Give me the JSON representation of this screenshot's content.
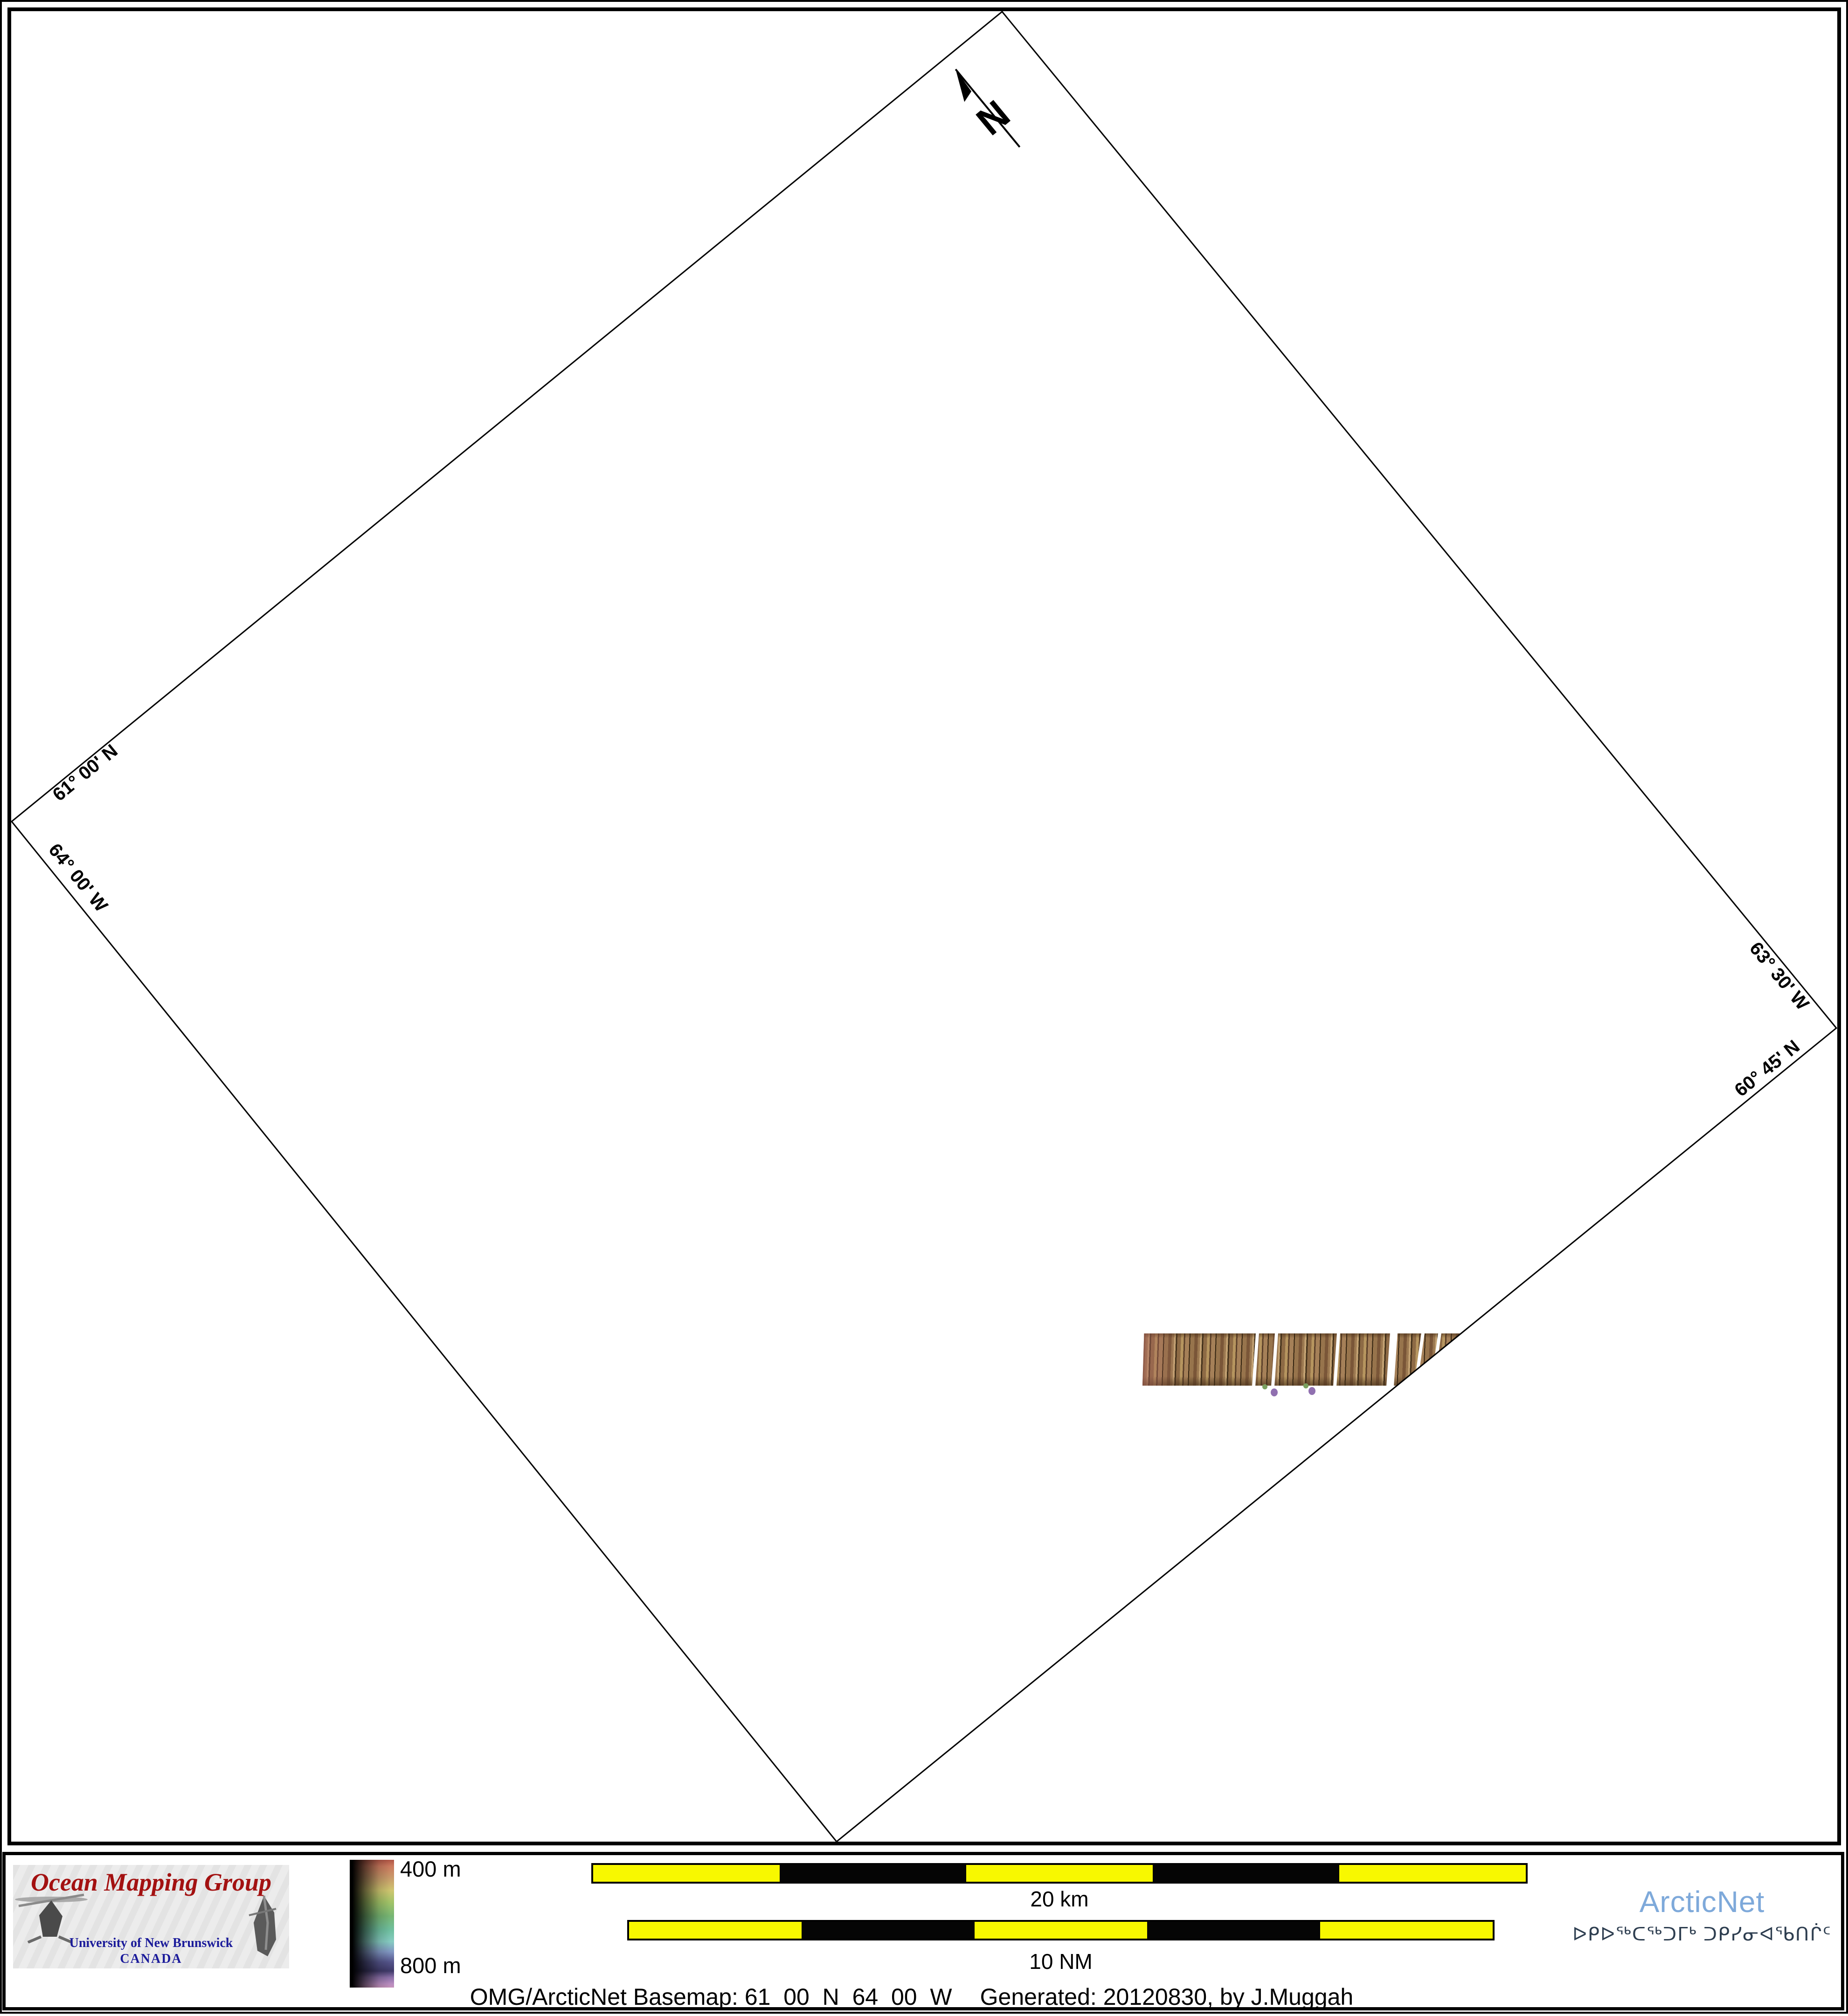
{
  "map": {
    "north_label": "N",
    "corner_labels": [
      {
        "text": "61° 00' N"
      },
      {
        "text": "64° 00' W"
      },
      {
        "text": "63° 30' W"
      },
      {
        "text": "60° 45' N"
      }
    ]
  },
  "colorbar": {
    "top_label": "400 m",
    "bottom_label": "800 m"
  },
  "scalebars": [
    {
      "label": "20 km"
    },
    {
      "label": "10 NM"
    }
  ],
  "omg_logo": {
    "title": "Ocean Mapping Group",
    "university": "University of New Brunswick",
    "country": "CANADA"
  },
  "arcticnet_logo": {
    "name": "ArcticNet",
    "inuktitut": "ᐅᑭᐅᖅᑕᖅᑐᒥᒃ ᑐᑭᓯᓂᐊᖃᑎᒌᑦ"
  },
  "caption": {
    "left": "OMG/ArcticNet Basemap: 61_00_N_64_00_W",
    "right": "Generated: 20120830, by J.Muggah"
  },
  "colors": {
    "scalebar_yellow": "#f8f800",
    "omg_title_red": "#a31111",
    "unb_blue": "#1b1b9a",
    "arcticnet_blue": "#7ea9da",
    "inuktitut_navy": "#2e3e50",
    "swath_brown": "#9a744e",
    "swath_dark": "#42301a",
    "swath_light": "#c3a273",
    "swath_pink_edge": "#a8645a",
    "dot_green": "#7aa05f",
    "dot_purple": "#9070b0",
    "colorbar_top": "#cc7a5e",
    "colorbar_bottom": "#c693bb"
  }
}
